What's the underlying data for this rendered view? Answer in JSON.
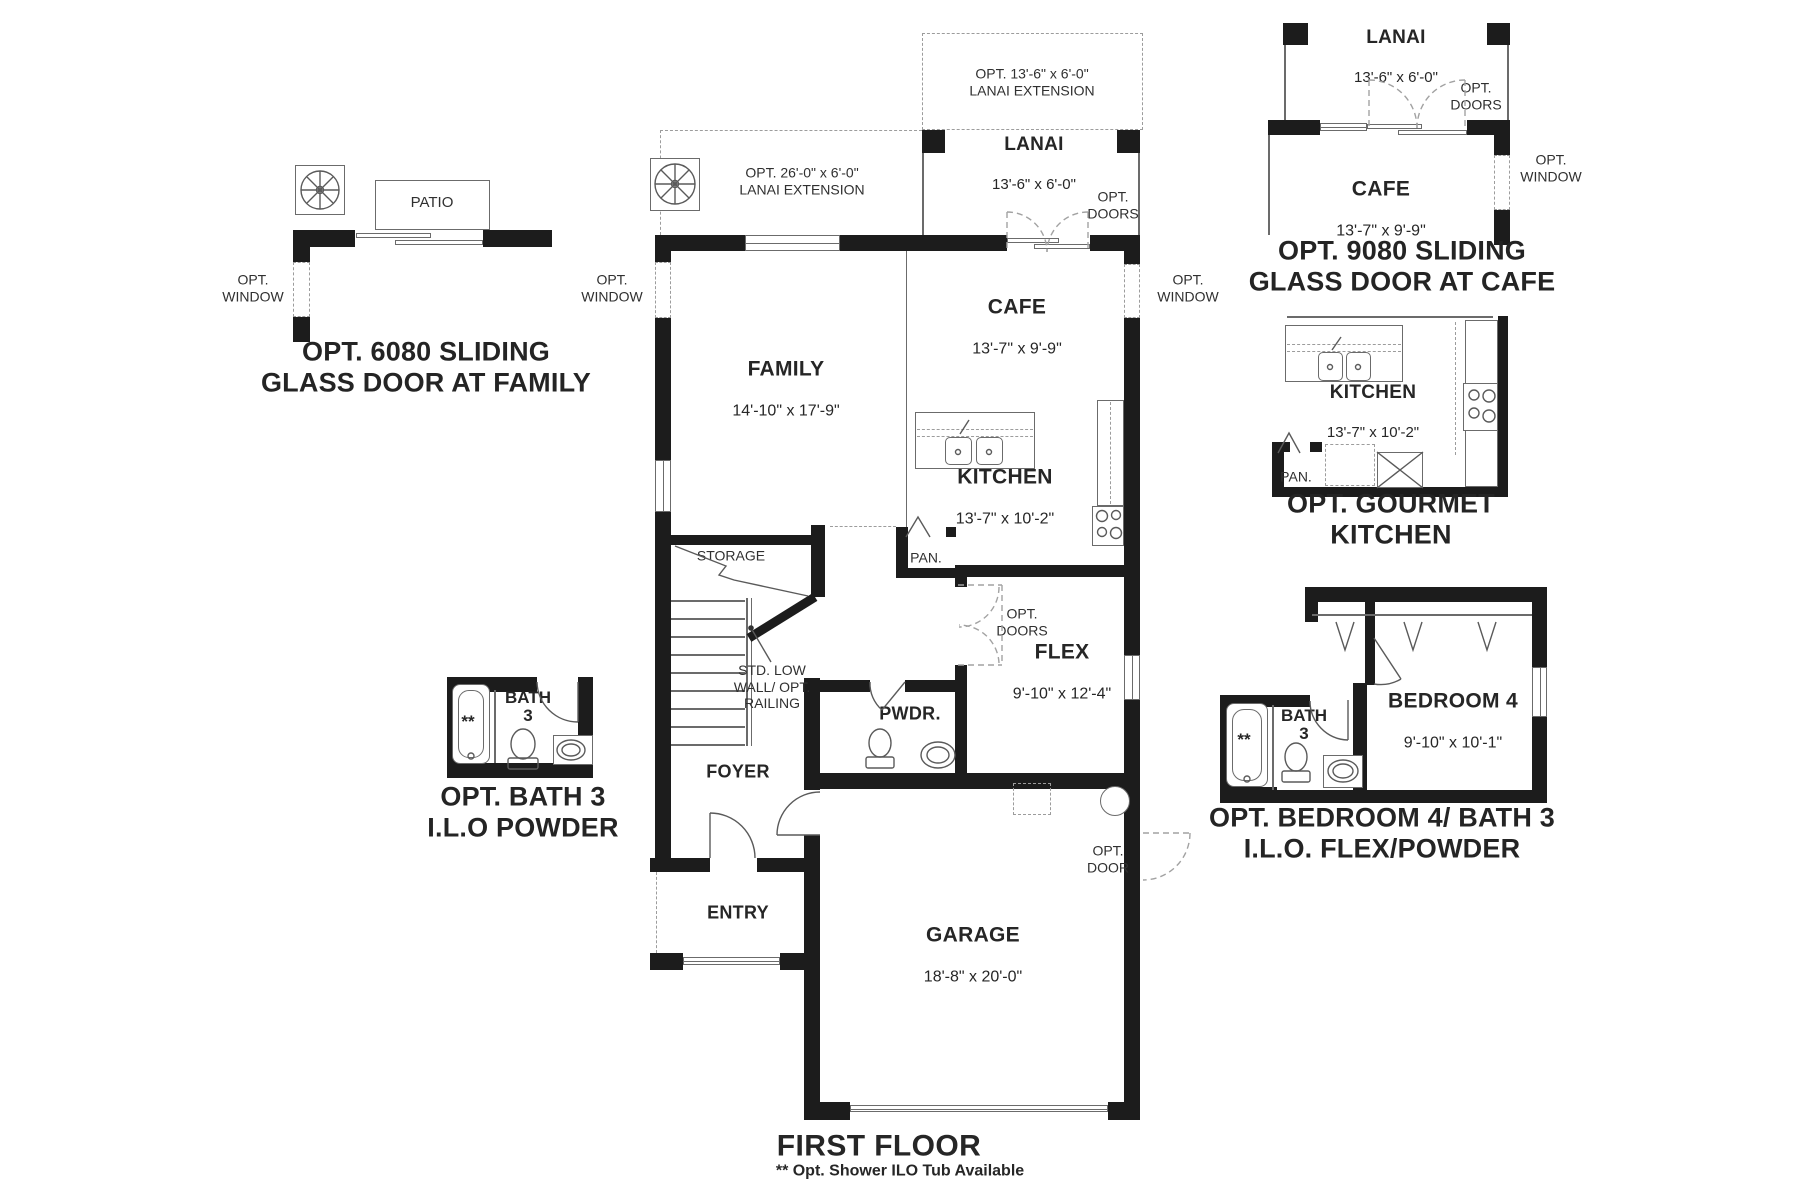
{
  "page": {
    "title": "FIRST FLOOR",
    "footnote": "** Opt. Shower ILO Tub Available"
  },
  "colors": {
    "wall": "#1c1c1c",
    "thin_line": "#6b6b6b",
    "dashed": "#9c9c9c",
    "text": "#262626"
  },
  "main_plan": {
    "family": {
      "name": "FAMILY",
      "dims": "14'-10\" x 17'-9\""
    },
    "cafe": {
      "name": "CAFE",
      "dims": "13'-7\" x 9'-9\""
    },
    "kitchen": {
      "name": "KITCHEN",
      "dims": "13'-7\" x 10'-2\""
    },
    "lanai": {
      "name": "LANAI",
      "dims": "13'-6\" x 6'-0\""
    },
    "flex": {
      "name": "FLEX",
      "dims": "9'-10\" x 12'-4\""
    },
    "garage": {
      "name": "GARAGE",
      "dims": "18'-8\" x 20'-0\""
    },
    "foyer": "FOYER",
    "entry": "ENTRY",
    "powder": "PWDR.",
    "storage": "STORAGE",
    "pantry": "PAN.",
    "stair_note": "STD. LOW\nWALL/ OPT.\nRAILING",
    "opt_window": "OPT.\nWINDOW",
    "opt_doors": "OPT.\nDOORS",
    "opt_door": "OPT.\nDOOR",
    "lanai_extension_13": "OPT. 13'-6\" x 6'-0\"\nLANAI EXTENSION",
    "lanai_extension_26": "OPT. 26'-0\" x 6'-0\"\nLANAI EXTENSION"
  },
  "inset_family_door": {
    "patio": "PATIO",
    "opt_window": "OPT.\nWINDOW",
    "caption": "OPT. 6080 SLIDING\nGLASS DOOR AT FAMILY"
  },
  "inset_cafe_door": {
    "lanai": {
      "name": "LANAI",
      "dims": "13'-6\" x 6'-0\""
    },
    "cafe": {
      "name": "CAFE",
      "dims": "13'-7\" x 9'-9\""
    },
    "opt_doors": "OPT.\nDOORS",
    "opt_window": "OPT.\nWINDOW",
    "caption": "OPT. 9080 SLIDING\nGLASS DOOR AT CAFE"
  },
  "inset_gourmet_kitchen": {
    "kitchen": {
      "name": "KITCHEN",
      "dims": "13'-7\" x 10'-2\""
    },
    "pantry": "PAN.",
    "caption": "OPT. GOURMET\nKITCHEN"
  },
  "inset_bath3": {
    "bath": "BATH\n3",
    "shower_note": "**",
    "caption": "OPT. BATH 3\nI.L.O POWDER"
  },
  "inset_bedroom4": {
    "bedroom": {
      "name": "BEDROOM 4",
      "dims": "9'-10\" x 10'-1\""
    },
    "bath": "BATH\n3",
    "shower_note": "**",
    "caption": "OPT. BEDROOM 4/ BATH 3\nI.L.O. FLEX/POWDER"
  }
}
